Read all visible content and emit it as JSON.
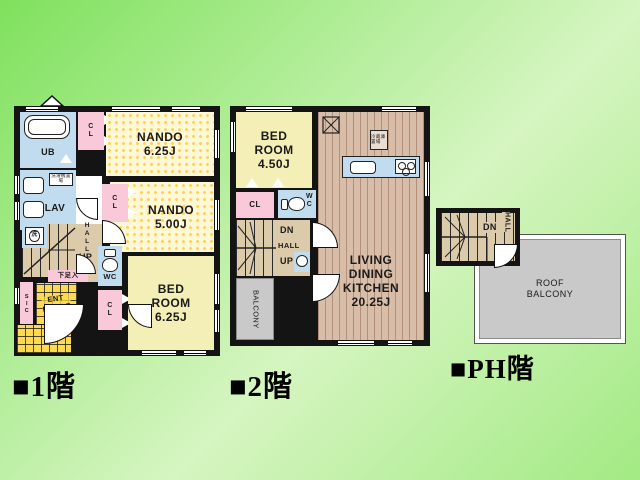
{
  "title_labels": {
    "floor1": "■1階",
    "floor2": "■2階",
    "floorPH": "■PH階"
  },
  "floor1": {
    "ub": "UB",
    "lav": "LAV",
    "washer_place": "洗濯機置場",
    "washer": "洗",
    "cl_top": "C\nL",
    "cl_nando": "C\nL",
    "cl_bed": "C\nL",
    "nando1_name": "NANDO",
    "nando1_area": "6.25J",
    "nando2_name": "NANDO",
    "nando2_area": "5.00J",
    "bedroom_name": "BED\nROOM",
    "bedroom_area": "6.25J",
    "hall": "HALL",
    "up": "UP",
    "wc": "WC",
    "shoe": "下足入",
    "sic": "SIC",
    "entrance": "ENT\nRANCE"
  },
  "floor2": {
    "bedroom_name": "BED\nROOM",
    "bedroom_area": "4.50J",
    "ldk_name": "LIVING\nDINING\nKITCHEN",
    "ldk_area": "20.25J",
    "fridge": "冷蔵庫置場",
    "cl": "CL",
    "wc": "W\nC",
    "dn": "DN",
    "hall": "HALL",
    "up": "UP",
    "balcony": "BALCONY"
  },
  "floorPH": {
    "dn": "DN",
    "hall": "HALL",
    "roof_balcony": "ROOF\nBALCONY"
  }
}
